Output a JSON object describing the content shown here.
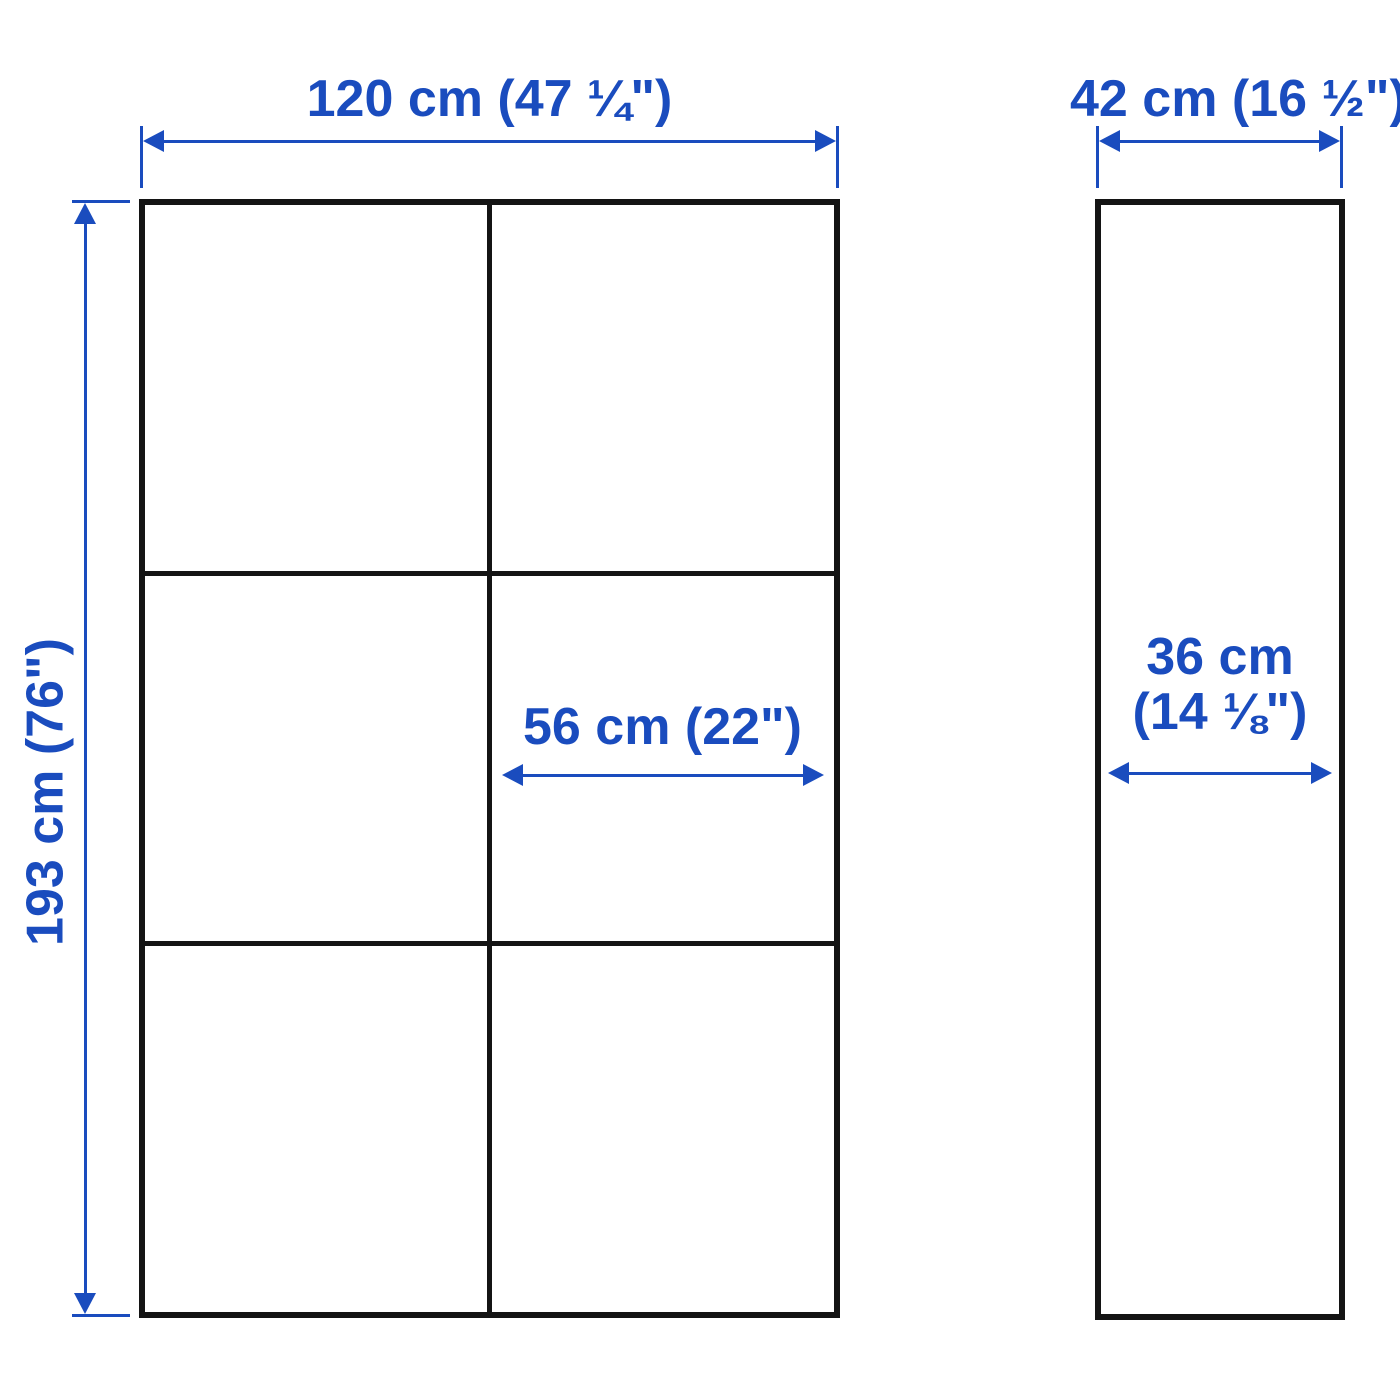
{
  "colors": {
    "dimension_blue": "#1a4cbe",
    "outline_black": "#141414",
    "background": "#ffffff"
  },
  "front_view": {
    "width_label": "120 cm (47 ¼\")",
    "height_label": "193 cm (76\")",
    "cell_width_label": "56 cm (22\")"
  },
  "side_view": {
    "depth_label": "42 cm (16 ½\")",
    "inner_depth_label_line1": "36 cm",
    "inner_depth_label_line2": "(14 ⅛\")"
  }
}
